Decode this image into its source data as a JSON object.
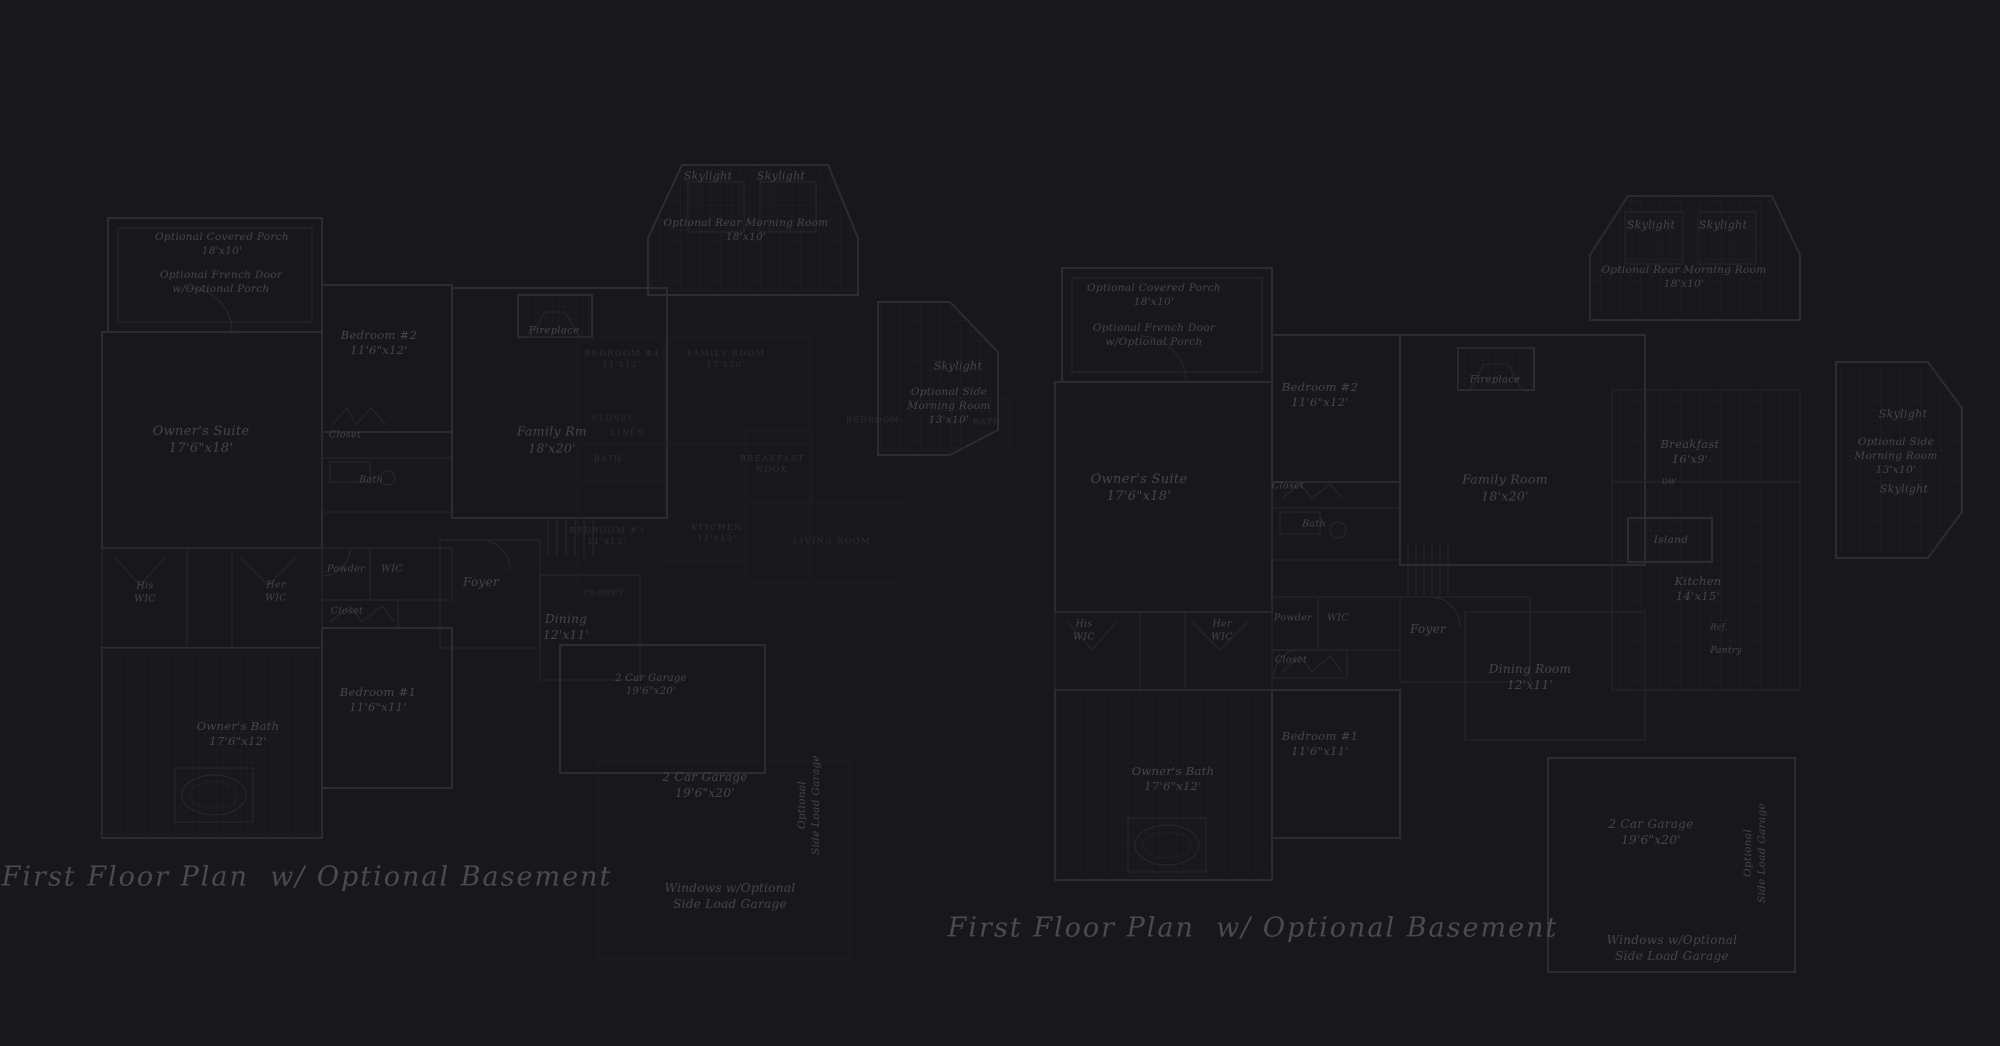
{
  "canvas": {
    "width": 2000,
    "height": 1046,
    "background": "#18181b"
  },
  "palette": {
    "wall": "#2c2c31",
    "wall_thin": "#26262b",
    "overlay_line": "#1f1f24",
    "grid_line": "#202026",
    "tile_line": "#1e1e23",
    "label_text": "#45454d",
    "caps_text": "#2d2d33",
    "title_text": "#4a4a52"
  },
  "plans": [
    {
      "id": "left-main",
      "title": {
        "text": "First Floor Plan  w/ Optional Basement",
        "x": 307,
        "y": 877
      },
      "labels": [
        {
          "name": "optional-covered-porch-label",
          "x": 222,
          "y": 245,
          "size": 10.5,
          "style": "room",
          "lines": [
            "Optional Covered Porch",
            "18'x10'"
          ]
        },
        {
          "name": "optional-french-door-label",
          "x": 221,
          "y": 283,
          "size": 10.5,
          "style": "room",
          "lines": [
            "Optional French Door",
            "w/Optional Porch"
          ]
        },
        {
          "name": "bedroom-2-label",
          "x": 379,
          "y": 343,
          "size": 11.5,
          "style": "room",
          "lines": [
            "Bedroom #2",
            "11'6\"x12'"
          ]
        },
        {
          "name": "owners-suite-label",
          "x": 201,
          "y": 440,
          "size": 13,
          "style": "room",
          "lines": [
            "Owner's Suite",
            "17'6\"x18'"
          ]
        },
        {
          "name": "closet-bedroom2-label",
          "x": 345,
          "y": 436,
          "size": 9.5,
          "style": "room",
          "lines": [
            "Closet"
          ]
        },
        {
          "name": "bath-bedroom2-label",
          "x": 371,
          "y": 481,
          "size": 9.5,
          "style": "room",
          "lines": [
            "Bath"
          ]
        },
        {
          "name": "fireplace-label",
          "x": 554,
          "y": 331,
          "size": 10,
          "style": "room",
          "lines": [
            "Fireplace"
          ]
        },
        {
          "name": "skylight-left-label",
          "x": 708,
          "y": 177,
          "size": 11,
          "style": "room",
          "lines": [
            "Skylight"
          ]
        },
        {
          "name": "skylight-right-label",
          "x": 781,
          "y": 177,
          "size": 11,
          "style": "room",
          "lines": [
            "Skylight"
          ]
        },
        {
          "name": "rear-morning-room-label",
          "x": 746,
          "y": 231,
          "size": 10.5,
          "style": "room",
          "lines": [
            "Optional Rear Morning Room",
            "18'x10'"
          ]
        },
        {
          "name": "family-room-label",
          "x": 552,
          "y": 440,
          "size": 12.5,
          "style": "room",
          "lines": [
            "Family Rm",
            "18'x20'"
          ]
        },
        {
          "name": "his-wic-label",
          "x": 145,
          "y": 593,
          "size": 9.5,
          "style": "room",
          "lines": [
            "His",
            "WIC"
          ]
        },
        {
          "name": "her-wic-label",
          "x": 276,
          "y": 592,
          "size": 9.5,
          "style": "room",
          "lines": [
            "Her",
            "WIC"
          ]
        },
        {
          "name": "powder-label",
          "x": 346,
          "y": 570,
          "size": 9.5,
          "style": "room",
          "lines": [
            "Powder"
          ]
        },
        {
          "name": "wic-label",
          "x": 392,
          "y": 570,
          "size": 9.5,
          "style": "room",
          "lines": [
            "WIC"
          ]
        },
        {
          "name": "closet-hall-label",
          "x": 347,
          "y": 612,
          "size": 9.5,
          "style": "room",
          "lines": [
            "Closet"
          ]
        },
        {
          "name": "foyer-label",
          "x": 481,
          "y": 583,
          "size": 12,
          "style": "room",
          "lines": [
            "Foyer"
          ]
        },
        {
          "name": "dining-label",
          "x": 566,
          "y": 628,
          "size": 12,
          "style": "room",
          "lines": [
            "Dining",
            "12'x11'"
          ]
        },
        {
          "name": "bedroom-1-label",
          "x": 378,
          "y": 700,
          "size": 11.5,
          "style": "room",
          "lines": [
            "Bedroom #1",
            "11'6\"x11'"
          ]
        },
        {
          "name": "owners-bath-label",
          "x": 238,
          "y": 734,
          "size": 11.5,
          "style": "room",
          "lines": [
            "Owner's Bath",
            "17'6\"x12'"
          ]
        },
        {
          "name": "garage-label",
          "x": 651,
          "y": 685,
          "size": 10,
          "style": "room",
          "lines": [
            "2 Car Garage",
            "19'6\"x20'"
          ]
        },
        {
          "name": "skylight-side-label",
          "x": 958,
          "y": 367,
          "size": 11,
          "style": "room",
          "lines": [
            "Skylight"
          ]
        },
        {
          "name": "side-morning-room-label",
          "x": 949,
          "y": 407,
          "size": 10.5,
          "style": "room",
          "lines": [
            "Optional Side",
            "Morning Room",
            "13'x10'"
          ]
        }
      ]
    },
    {
      "id": "left-overlay",
      "labels": [
        {
          "name": "overlay-bedroom4-label",
          "x": 622,
          "y": 360,
          "size": 8.5,
          "style": "caps",
          "lines": [
            "BEDROOM #4",
            "11'x12'"
          ]
        },
        {
          "name": "overlay-family-room-label",
          "x": 726,
          "y": 360,
          "size": 8.5,
          "style": "caps",
          "lines": [
            "FAMILY ROOM",
            "17'x20'"
          ]
        },
        {
          "name": "overlay-closet-1-label",
          "x": 613,
          "y": 419,
          "size": 8,
          "style": "caps",
          "lines": [
            "CLOSET"
          ]
        },
        {
          "name": "overlay-linen-label",
          "x": 628,
          "y": 434,
          "size": 8,
          "style": "caps",
          "lines": [
            "LINEN"
          ]
        },
        {
          "name": "overlay-bath-1-label",
          "x": 608,
          "y": 460,
          "size": 8,
          "style": "caps",
          "lines": [
            "BATH"
          ]
        },
        {
          "name": "overlay-breakfast-nook-label",
          "x": 772,
          "y": 465,
          "size": 8.5,
          "style": "caps",
          "lines": [
            "BREAKFAST",
            "NOOK"
          ]
        },
        {
          "name": "overlay-kitchen-label",
          "x": 717,
          "y": 534,
          "size": 8.5,
          "style": "caps",
          "lines": [
            "KITCHEN",
            "11'x13'"
          ]
        },
        {
          "name": "overlay-bedroom3-label",
          "x": 607,
          "y": 537,
          "size": 8.5,
          "style": "caps",
          "lines": [
            "BEDROOM #3",
            "11'x13'"
          ]
        },
        {
          "name": "overlay-living-room-label",
          "x": 832,
          "y": 542,
          "size": 8.5,
          "style": "caps",
          "lines": [
            "LIVING ROOM"
          ]
        },
        {
          "name": "overlay-closet-2-label",
          "x": 604,
          "y": 594,
          "size": 8,
          "style": "caps",
          "lines": [
            "CLOSET"
          ]
        },
        {
          "name": "overlay-bath-2-label",
          "x": 987,
          "y": 423,
          "size": 8,
          "style": "caps",
          "lines": [
            "BATH"
          ]
        },
        {
          "name": "overlay-bedroom-label",
          "x": 873,
          "y": 421,
          "size": 8,
          "style": "caps",
          "lines": [
            "BEDROOM"
          ]
        },
        {
          "name": "overlay-garage-label",
          "x": 705,
          "y": 786,
          "size": 12,
          "style": "room",
          "lines": [
            "2 Car Garage",
            "19'6\"x20'"
          ]
        },
        {
          "name": "overlay-side-load-garage-label",
          "x": 810,
          "y": 805,
          "size": 10.5,
          "style": "vertical",
          "lines": [
            "Optional",
            "Side Load Garage"
          ]
        },
        {
          "name": "overlay-windows-label",
          "x": 730,
          "y": 897,
          "size": 12,
          "style": "room",
          "lines": [
            "Windows w/Optional",
            "Side Load Garage"
          ]
        }
      ]
    },
    {
      "id": "right-main",
      "title": {
        "text": "First Floor Plan  w/ Optional Basement",
        "x": 1253,
        "y": 928
      },
      "labels": [
        {
          "name": "optional-covered-porch-label",
          "x": 1154,
          "y": 296,
          "size": 10.5,
          "style": "room",
          "lines": [
            "Optional Covered Porch",
            "18'x10'"
          ]
        },
        {
          "name": "optional-french-door-label",
          "x": 1154,
          "y": 336,
          "size": 10.5,
          "style": "room",
          "lines": [
            "Optional French Door",
            "w/Optional Porch"
          ]
        },
        {
          "name": "bedroom-2-label",
          "x": 1320,
          "y": 395,
          "size": 11.5,
          "style": "room",
          "lines": [
            "Bedroom #2",
            "11'6\"x12'"
          ]
        },
        {
          "name": "owners-suite-label",
          "x": 1139,
          "y": 488,
          "size": 13,
          "style": "room",
          "lines": [
            "Owner's Suite",
            "17'6\"x18'"
          ]
        },
        {
          "name": "closet-bedroom2-label",
          "x": 1288,
          "y": 487,
          "size": 9.5,
          "style": "room",
          "lines": [
            "Closet"
          ]
        },
        {
          "name": "bath-bedroom2-label",
          "x": 1314,
          "y": 525,
          "size": 9.5,
          "style": "room",
          "lines": [
            "Bath"
          ]
        },
        {
          "name": "fireplace-label",
          "x": 1495,
          "y": 380,
          "size": 10,
          "style": "room",
          "lines": [
            "Fireplace"
          ]
        },
        {
          "name": "family-room-label",
          "x": 1505,
          "y": 488,
          "size": 12.5,
          "style": "room",
          "lines": [
            "Family Room",
            "18'x20'"
          ]
        },
        {
          "name": "skylight-left-label",
          "x": 1651,
          "y": 226,
          "size": 11,
          "style": "room",
          "lines": [
            "Skylight"
          ]
        },
        {
          "name": "skylight-right-label",
          "x": 1723,
          "y": 226,
          "size": 11,
          "style": "room",
          "lines": [
            "Skylight"
          ]
        },
        {
          "name": "rear-morning-room-label",
          "x": 1684,
          "y": 278,
          "size": 10.5,
          "style": "room",
          "lines": [
            "Optional Rear Morning Room",
            "18'x10'"
          ]
        },
        {
          "name": "breakfast-label",
          "x": 1690,
          "y": 452,
          "size": 11.5,
          "style": "room",
          "lines": [
            "Breakfast",
            "16'x9'"
          ]
        },
        {
          "name": "dw-label",
          "x": 1669,
          "y": 482,
          "size": 7.5,
          "style": "room",
          "lines": [
            "DW"
          ]
        },
        {
          "name": "island-label",
          "x": 1671,
          "y": 541,
          "size": 10.5,
          "style": "room",
          "lines": [
            "Island"
          ]
        },
        {
          "name": "kitchen-label",
          "x": 1698,
          "y": 589,
          "size": 11.5,
          "style": "room",
          "lines": [
            "Kitchen",
            "14'x15'"
          ]
        },
        {
          "name": "ref-label",
          "x": 1719,
          "y": 628,
          "size": 8,
          "style": "room",
          "lines": [
            "Ref."
          ]
        },
        {
          "name": "pantry-label",
          "x": 1726,
          "y": 652,
          "size": 9,
          "style": "room",
          "lines": [
            "Pantry"
          ]
        },
        {
          "name": "his-wic-label",
          "x": 1084,
          "y": 631,
          "size": 9.5,
          "style": "room",
          "lines": [
            "His",
            "WIC"
          ]
        },
        {
          "name": "her-wic-label",
          "x": 1222,
          "y": 631,
          "size": 9.5,
          "style": "room",
          "lines": [
            "Her",
            "WIC"
          ]
        },
        {
          "name": "powder-label",
          "x": 1293,
          "y": 619,
          "size": 9.5,
          "style": "room",
          "lines": [
            "Powder"
          ]
        },
        {
          "name": "wic-label",
          "x": 1338,
          "y": 619,
          "size": 9.5,
          "style": "room",
          "lines": [
            "WIC"
          ]
        },
        {
          "name": "closet-hall-label",
          "x": 1291,
          "y": 661,
          "size": 9.5,
          "style": "room",
          "lines": [
            "Closet"
          ]
        },
        {
          "name": "foyer-label",
          "x": 1428,
          "y": 630,
          "size": 12,
          "style": "room",
          "lines": [
            "Foyer"
          ]
        },
        {
          "name": "dining-room-label",
          "x": 1530,
          "y": 678,
          "size": 12,
          "style": "room",
          "lines": [
            "Dining Room",
            "12'x11'"
          ]
        },
        {
          "name": "bedroom-1-label",
          "x": 1320,
          "y": 744,
          "size": 11.5,
          "style": "room",
          "lines": [
            "Bedroom #1",
            "11'6\"x11'"
          ]
        },
        {
          "name": "owners-bath-label",
          "x": 1173,
          "y": 779,
          "size": 11.5,
          "style": "room",
          "lines": [
            "Owner's Bath",
            "17'6\"x12'"
          ]
        },
        {
          "name": "garage-label",
          "x": 1651,
          "y": 833,
          "size": 12,
          "style": "room",
          "lines": [
            "2 Car Garage",
            "19'6\"x20'"
          ]
        },
        {
          "name": "side-load-garage-label",
          "x": 1756,
          "y": 853,
          "size": 10.5,
          "style": "vertical",
          "lines": [
            "Optional",
            "Side Load Garage"
          ]
        },
        {
          "name": "windows-label",
          "x": 1672,
          "y": 949,
          "size": 12,
          "style": "room",
          "lines": [
            "Windows w/Optional",
            "Side Load Garage"
          ]
        },
        {
          "name": "skylight-side-top-label",
          "x": 1903,
          "y": 415,
          "size": 11,
          "style": "room",
          "lines": [
            "Skylight"
          ]
        },
        {
          "name": "side-morning-room-label",
          "x": 1896,
          "y": 457,
          "size": 10.5,
          "style": "room",
          "lines": [
            "Optional Side",
            "Morning Room",
            "13'x10'"
          ]
        },
        {
          "name": "skylight-side-bottom-label",
          "x": 1904,
          "y": 490,
          "size": 11,
          "style": "room",
          "lines": [
            "Skylight"
          ]
        }
      ]
    }
  ]
}
